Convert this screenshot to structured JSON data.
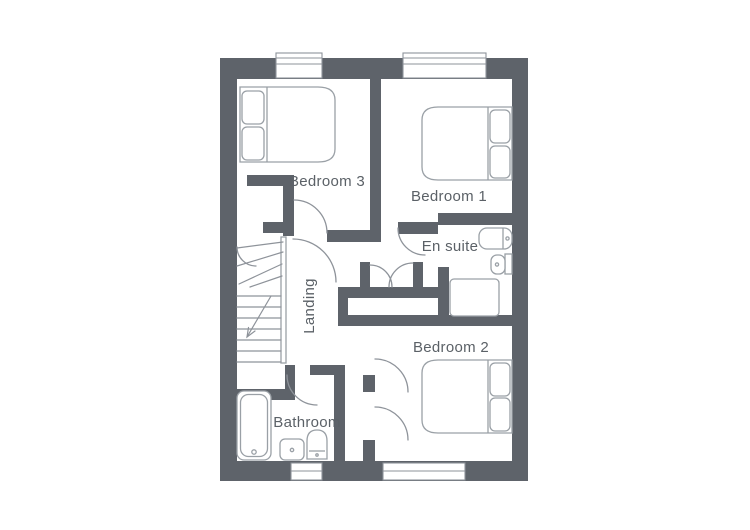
{
  "labels": {
    "bedroom3": "Bedroom 3",
    "bedroom1": "Bedroom 1",
    "ensuite": "En suite",
    "landing": "Landing",
    "bedroom2": "Bedroom 2",
    "bathroom": "Bathroom"
  },
  "colors": {
    "wall": "#5e636a",
    "line": "#8e939a",
    "furniture": "#9aa0a6",
    "text": "#5b6167",
    "background": "#ffffff"
  },
  "fixtures": {
    "bedroom3": [
      "double-bed"
    ],
    "bedroom1": [
      "double-bed"
    ],
    "bedroom2": [
      "double-bed"
    ],
    "ensuite": [
      "basin",
      "wc",
      "shower-tray"
    ],
    "bathroom": [
      "bath",
      "basin",
      "wc"
    ],
    "stairs": [
      "winder-staircase",
      "direction-arrow"
    ]
  }
}
